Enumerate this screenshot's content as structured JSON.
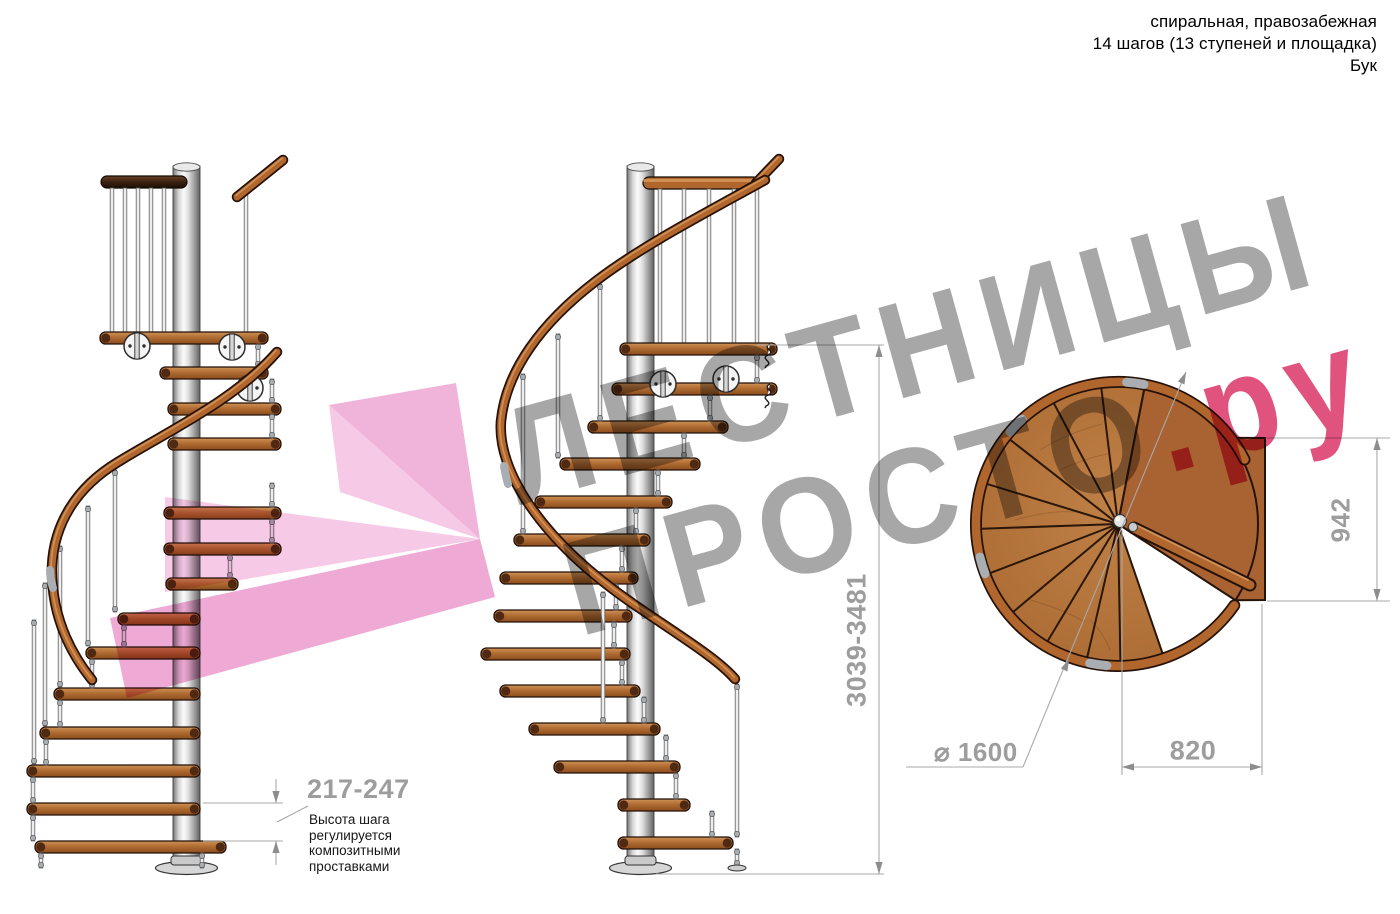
{
  "header": {
    "line1": "спиральная, правозабежная",
    "line2": "14 шагов (13 ступеней и площадка)",
    "line3": "Бук"
  },
  "dimensions": {
    "step_height": "217-247",
    "step_height_note": "Высота шага\nрегулируется\nкомпозитными\nпроставками",
    "total_height": "3039-3481",
    "platform_depth": "942",
    "diameter": "⌀ 1600",
    "platform_width": "820"
  },
  "watermark": {
    "line1": "ЛЕСТНИЦЫ",
    "line2_gray": "ПРОСТО",
    "line2_pink": ".ру"
  },
  "colors": {
    "wood": "#b5773f",
    "platform_wood": "#a96231",
    "rail": "#b0662c",
    "rail_outline": "#26120a",
    "dark_rail": "#3b2112",
    "tread_end": "#4f2912",
    "steel_light": "#ededed",
    "dimension_gray": "#9d9d9d",
    "dimension_line": "#a8a8a8",
    "watermark_gray": "#a7a7a7",
    "watermark_pink": "#e0537f",
    "watermark_shape_pink": "#f2b9de",
    "text_black": "#161616"
  }
}
